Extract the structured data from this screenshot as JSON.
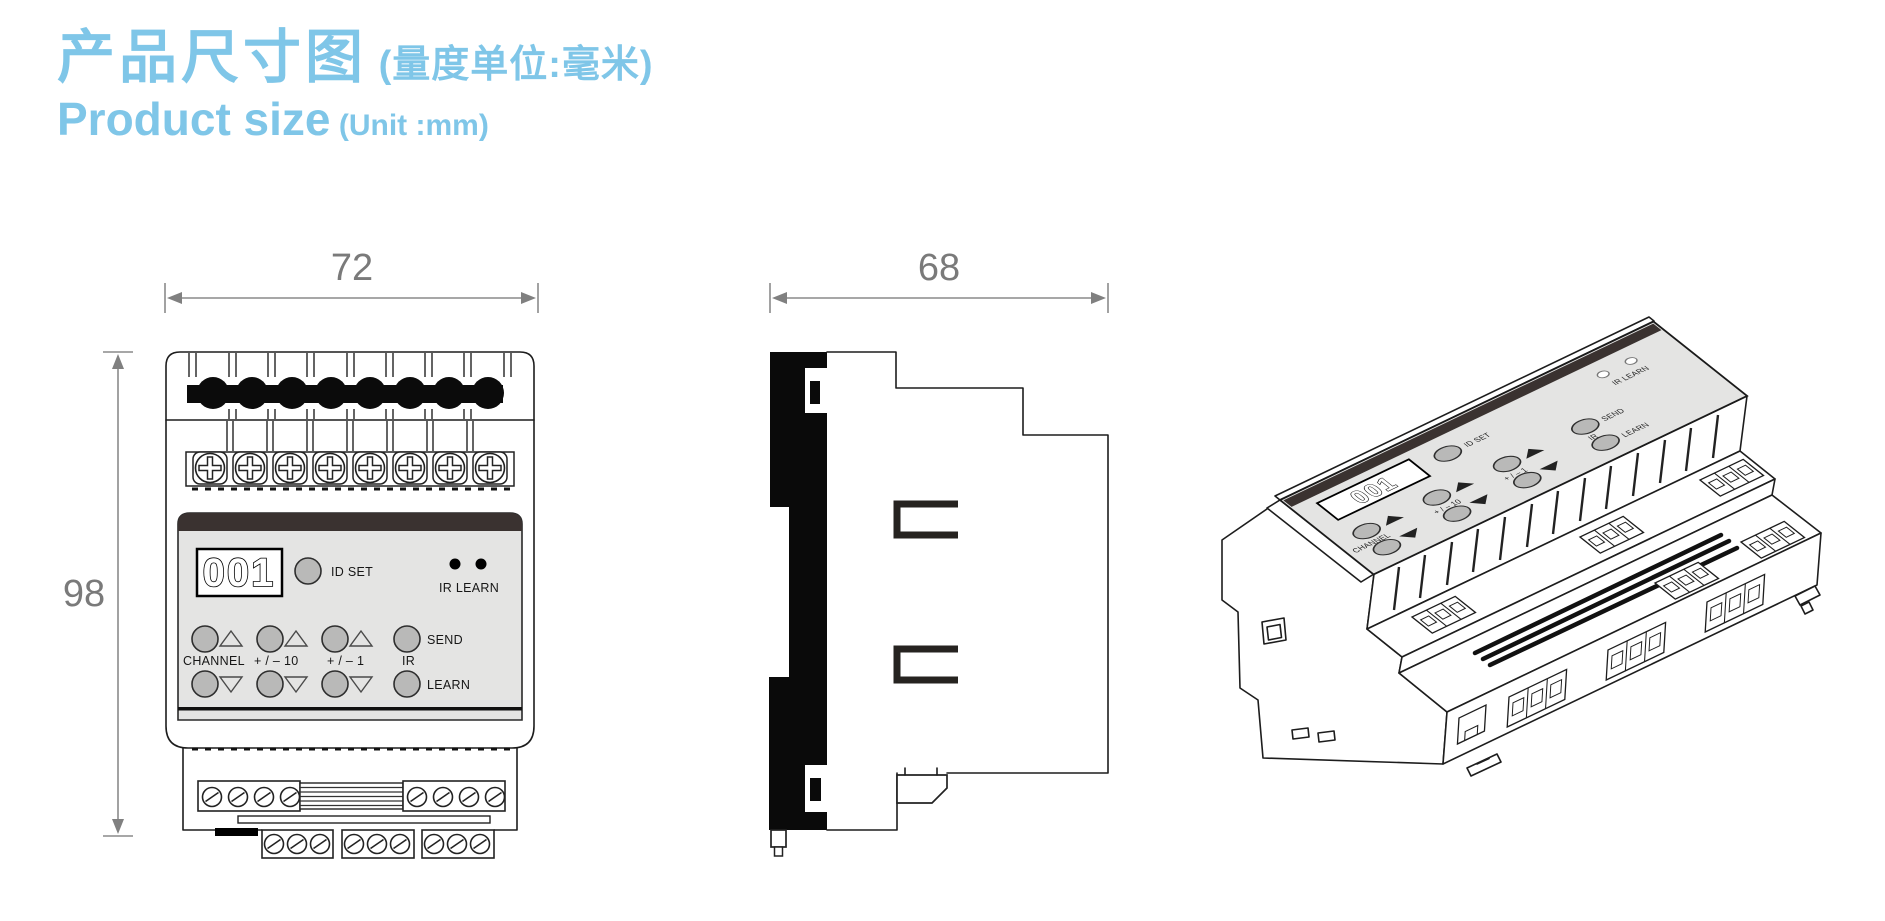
{
  "header": {
    "title_cn": "产品尺寸图",
    "title_cn_suffix": " (量度单位:毫米)",
    "title_en": "Product size",
    "title_en_suffix": " (Unit :mm)"
  },
  "front_view": {
    "width_mm": "72",
    "height_mm": "98",
    "panel": {
      "display_value": "001",
      "id_set_label": "ID SET",
      "ir_learn_label": "IR LEARN",
      "channel_label": "CHANNEL",
      "step10_label": "+ / – 10",
      "step1_label": "+ / – 1",
      "ir_label": "IR",
      "send_label": "SEND",
      "learn_label": "LEARN"
    }
  },
  "side_view": {
    "depth_mm": "68"
  },
  "iso_view": {
    "panel": {
      "display_value": "001",
      "id_set_label": "ID SET",
      "ir_learn_label": "IR LEARN",
      "channel_label": "CHANNEL",
      "step10_label": "+ / – 10",
      "step1_label": "+ / – 1",
      "ir_label": "IR",
      "send_label": "SEND",
      "learn_label": "LEARN"
    }
  },
  "colors": {
    "accent": "#7fc6e8",
    "dim_gray": "#7a7a7a",
    "panel_gray": "#e4e4e3",
    "stripe_dark": "#3a3230",
    "button_gray": "#b9b9b8"
  }
}
